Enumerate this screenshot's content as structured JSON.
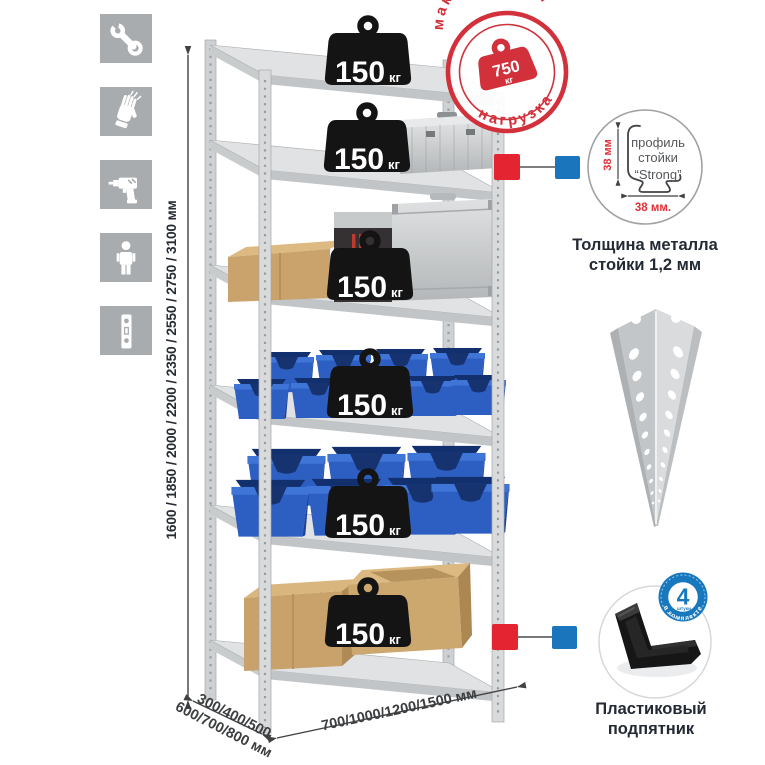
{
  "sidebar": {
    "icons": [
      {
        "name": "wrench-icon"
      },
      {
        "name": "gloves-icon"
      },
      {
        "name": "drill-icon"
      },
      {
        "name": "person-icon"
      },
      {
        "name": "level-icon"
      }
    ]
  },
  "rack": {
    "shelf_count": 6,
    "shelf_load": {
      "value": "150",
      "unit": "кг"
    }
  },
  "max_load_stamp": {
    "arc_top": "максимальная",
    "arc_bottom": "нагрузка",
    "value": "750",
    "unit": "кг"
  },
  "dimensions": {
    "height": "1600 / 1850 / 2000 / 2200 / 2350 / 2550 / 2750 / 3100 мм",
    "depth_line1": "300/400/500",
    "depth_line2": "600/700/800 мм",
    "width": "700/1000/1200/1500 мм"
  },
  "profile_detail": {
    "line1": "профиль",
    "line2": "стойки",
    "line3": "“Strong”",
    "vertical_dim": "38 мм",
    "horizontal_dim": "38 мм.",
    "caption_line1": "Толщина металла",
    "caption_line2": "стойки 1,2 мм"
  },
  "foot_detail": {
    "badge_value": "4",
    "badge_unit": "штуки",
    "badge_arc": "в комплекте",
    "caption_line1": "Пластиковый",
    "caption_line2": "подпятник"
  },
  "colors": {
    "stamp_red": "#d2313b",
    "marker_red": "#e42430",
    "marker_blue": "#1b75bc",
    "badge_blue": "#1878be",
    "bin_blue": "#2d5ec2",
    "cardboard": "#c9a36b",
    "metal_light": "#e0e2e3",
    "icon_gray": "#a9acae",
    "weight_black": "#141414"
  }
}
